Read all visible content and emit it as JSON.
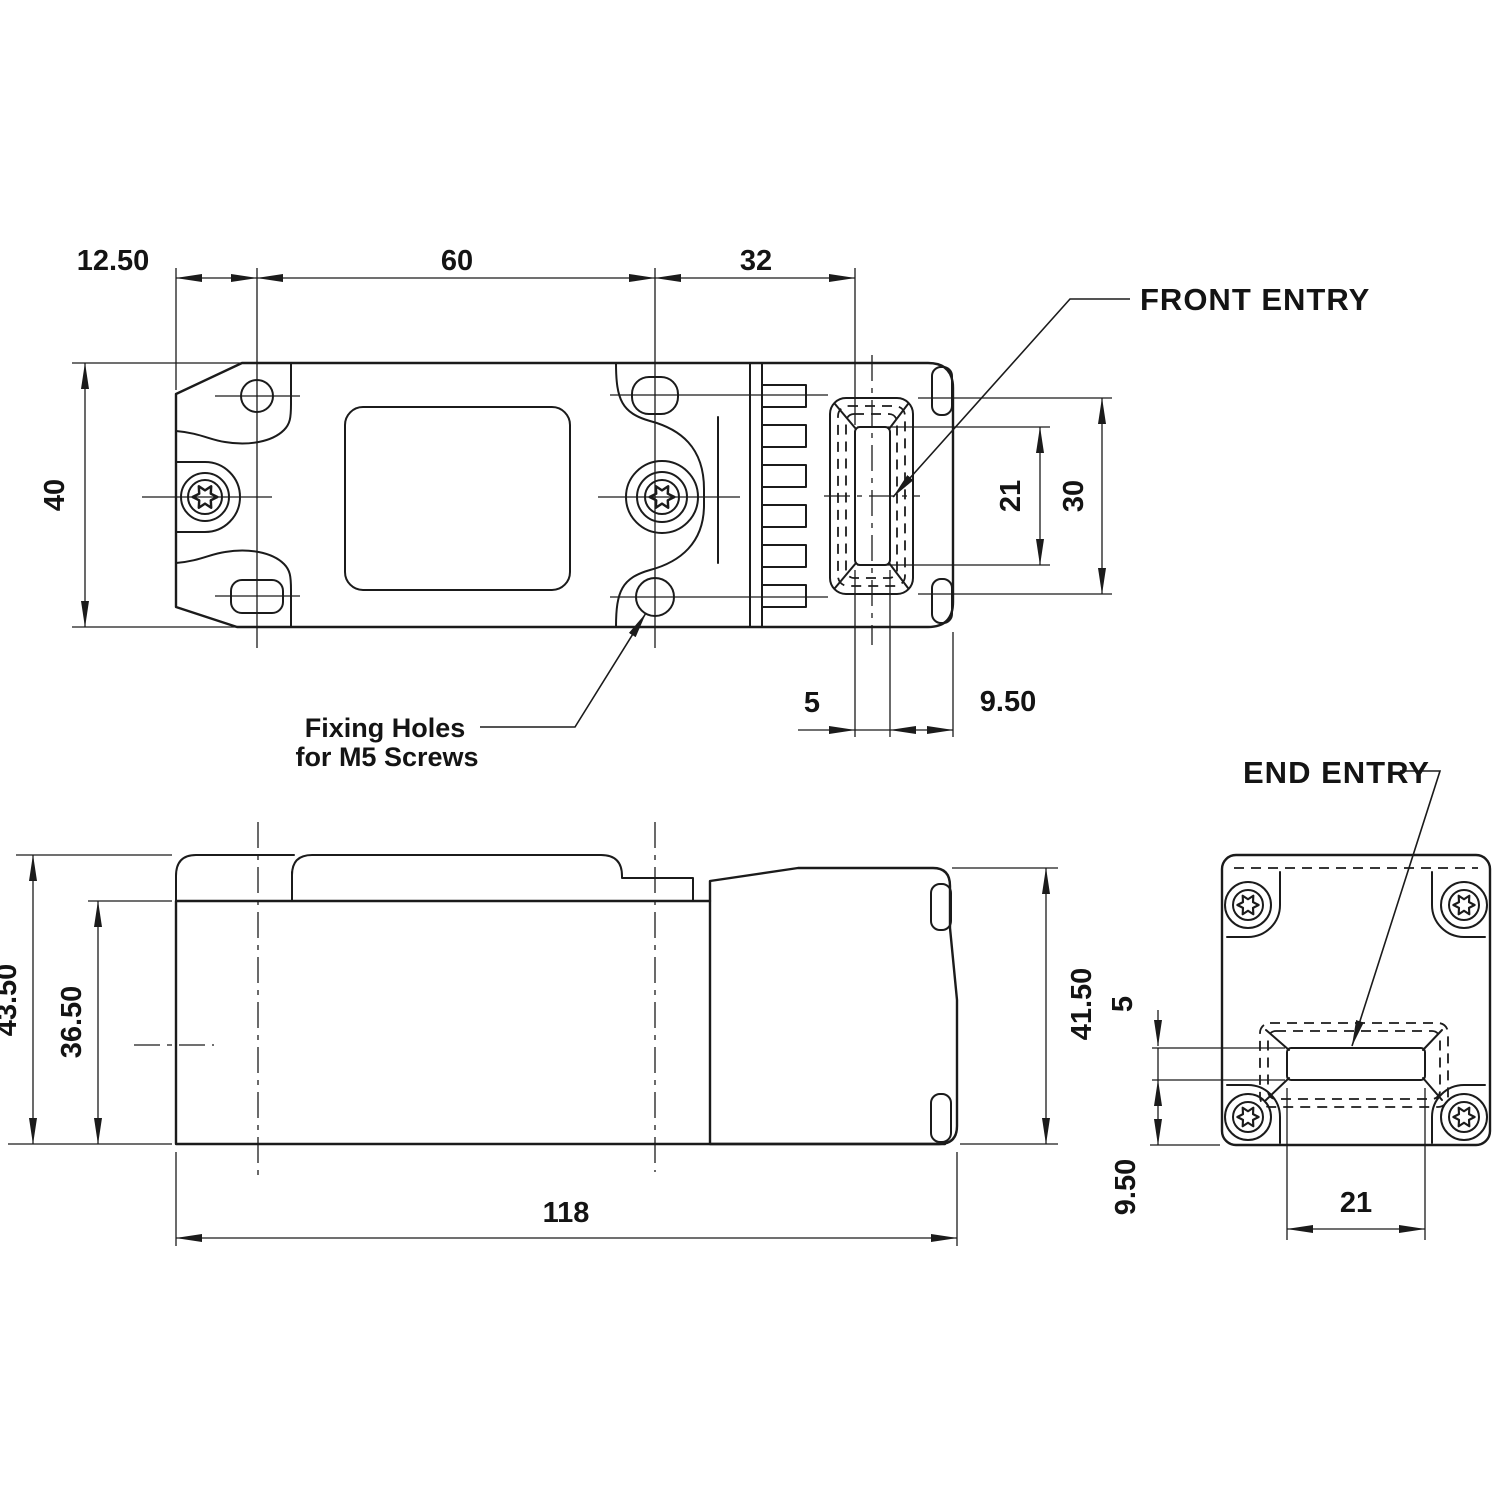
{
  "colors": {
    "line": "#1b1b1b",
    "background": "#ffffff"
  },
  "labels": {
    "front_entry": "FRONT ENTRY",
    "end_entry": "END ENTRY",
    "fixing_holes_line1": "Fixing Holes",
    "fixing_holes_line2": "for M5 Screws"
  },
  "top_view": {
    "dims": {
      "left_offset": "12.50",
      "hole_spacing": "60",
      "head_offset": "32",
      "body_width": "40",
      "entry_height": "21",
      "opening_height": "30",
      "slot_width": "5",
      "right_margin": "9.50"
    }
  },
  "side_view": {
    "dims": {
      "total_height": "43.50",
      "body_height": "36.50",
      "head_height": "41.50",
      "overall_length": "118"
    }
  },
  "end_view": {
    "dims": {
      "slot_height": "5",
      "bottom_offset": "9.50",
      "slot_width": "21"
    }
  }
}
